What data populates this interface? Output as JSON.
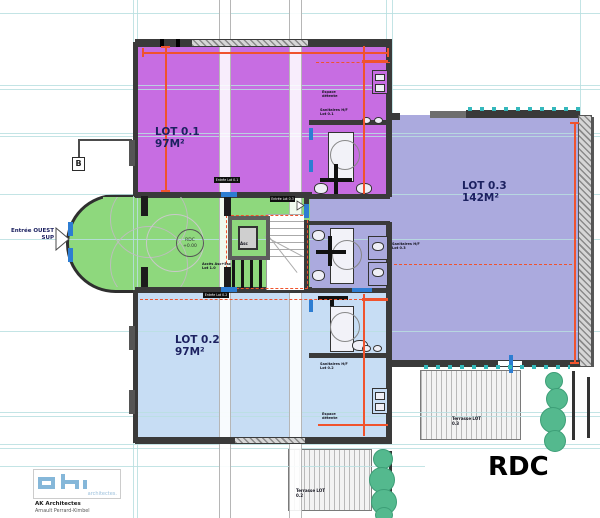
{
  "sheet_title": "RDC",
  "level_marker": {
    "level": "RDC",
    "elevation": "+0.00"
  },
  "lots": [
    {
      "name": "LOT 0.1",
      "area": "97M²"
    },
    {
      "name": "LOT 0.2",
      "area": "97M²"
    },
    {
      "name": "LOT 0.3",
      "area": "142M²"
    }
  ],
  "west_entrance": {
    "line1": "Entrée OUEST",
    "line2": "SUP"
  },
  "section_marker": "B",
  "entry_tags": {
    "lot01": "Entrée Lot 0.1",
    "lot02": "Entrée Lot 0.2",
    "lot03": "Entrée Lot 0.3"
  },
  "annotations": {
    "sanitaires_lot01": "Sanitaires H/F Lot 0.1",
    "sanitaires_lot02": "Sanitaires H/F Lot 0.2",
    "sanitaires_lot03": "Sanitaires H/F Lot 0.3",
    "espace_detente": "Espace détente",
    "acces_asc": "Accès Asc+Esc Lot 1.0",
    "ascenseur": "Asc"
  },
  "terraces": {
    "lot02": "Terrasse LOT 0.2",
    "lot03": "Terrasse LOT 0.3"
  },
  "logo": {
    "wordmark": "architectes.",
    "firm": "AK Architectes",
    "architect": "Arnault Perrard-Kimbel"
  },
  "colors": {
    "lot01_fill": "#c76de2",
    "lot02_fill": "#c7ddf4",
    "lot03_fill": "#abaade",
    "hall_fill": "#8ed87d",
    "dimension_orange": "#f0532d",
    "grid_teal": "#b9dfe0",
    "door_blue": "#2d7dd2",
    "tree_green": "#54b98e",
    "logo_blue": "#85b7d9"
  }
}
